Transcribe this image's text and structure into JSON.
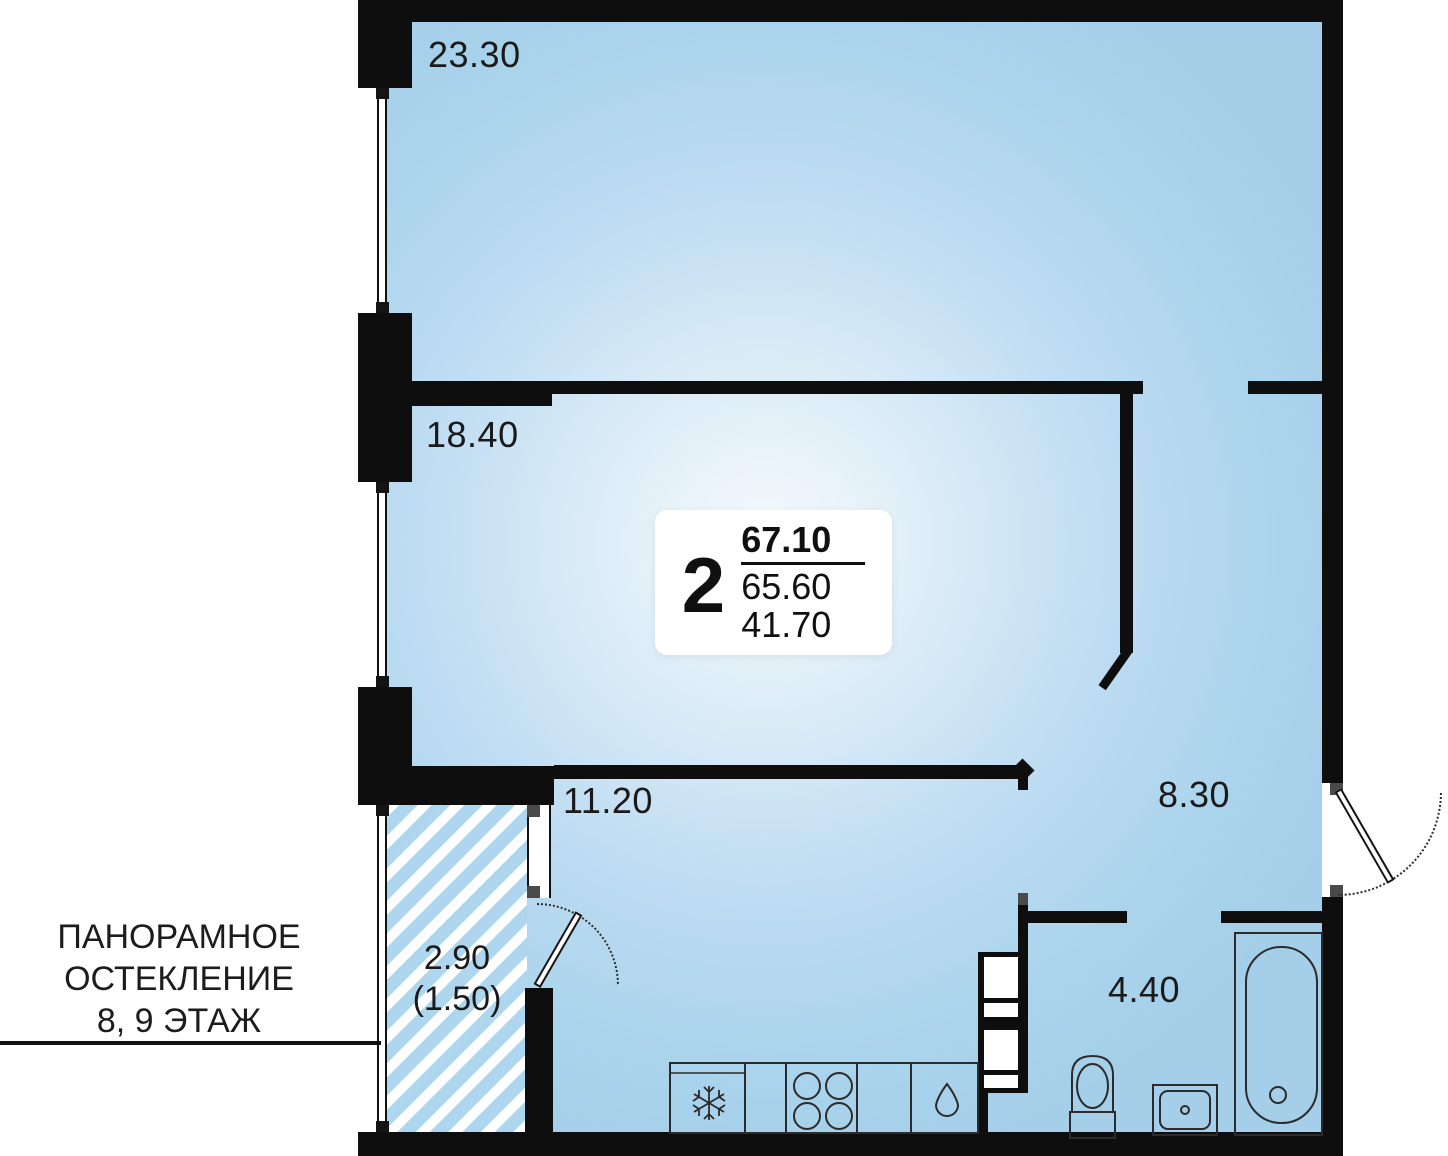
{
  "plan": {
    "info_card": {
      "rooms_count": "2",
      "total_area": "67.10",
      "area_without_balcony": "65.60",
      "living_area": "41.70"
    },
    "rooms": [
      {
        "id": "room-top",
        "area_label": "23.30"
      },
      {
        "id": "room-middle",
        "area_label": "18.40"
      },
      {
        "id": "kitchen",
        "area_label": "11.20"
      },
      {
        "id": "hallway",
        "area_label": "8.30"
      },
      {
        "id": "bathroom",
        "area_label": "4.40"
      },
      {
        "id": "balcony",
        "area_label": "2.90",
        "area_label_reduced": "(1.50)"
      }
    ],
    "annotation": {
      "line1": "ПАНОРАМНОЕ",
      "line2": "ОСТЕКЛЕНИЕ",
      "line3": "8, 9 ЭТАЖ"
    },
    "fixtures": [
      "fridge-snowflake-icon",
      "stove-burners-icon",
      "kitchen-sink-drop-icon",
      "toilet",
      "washbasin",
      "bathtub",
      "ventilation-shaft"
    ],
    "colors": {
      "wall": "#0e0e0e",
      "room_fill": "#aad4ec",
      "room_glow": "#f6fafd",
      "hatch_blue": "#aed7ef",
      "jamb_gray": "#4a4a4a"
    }
  }
}
